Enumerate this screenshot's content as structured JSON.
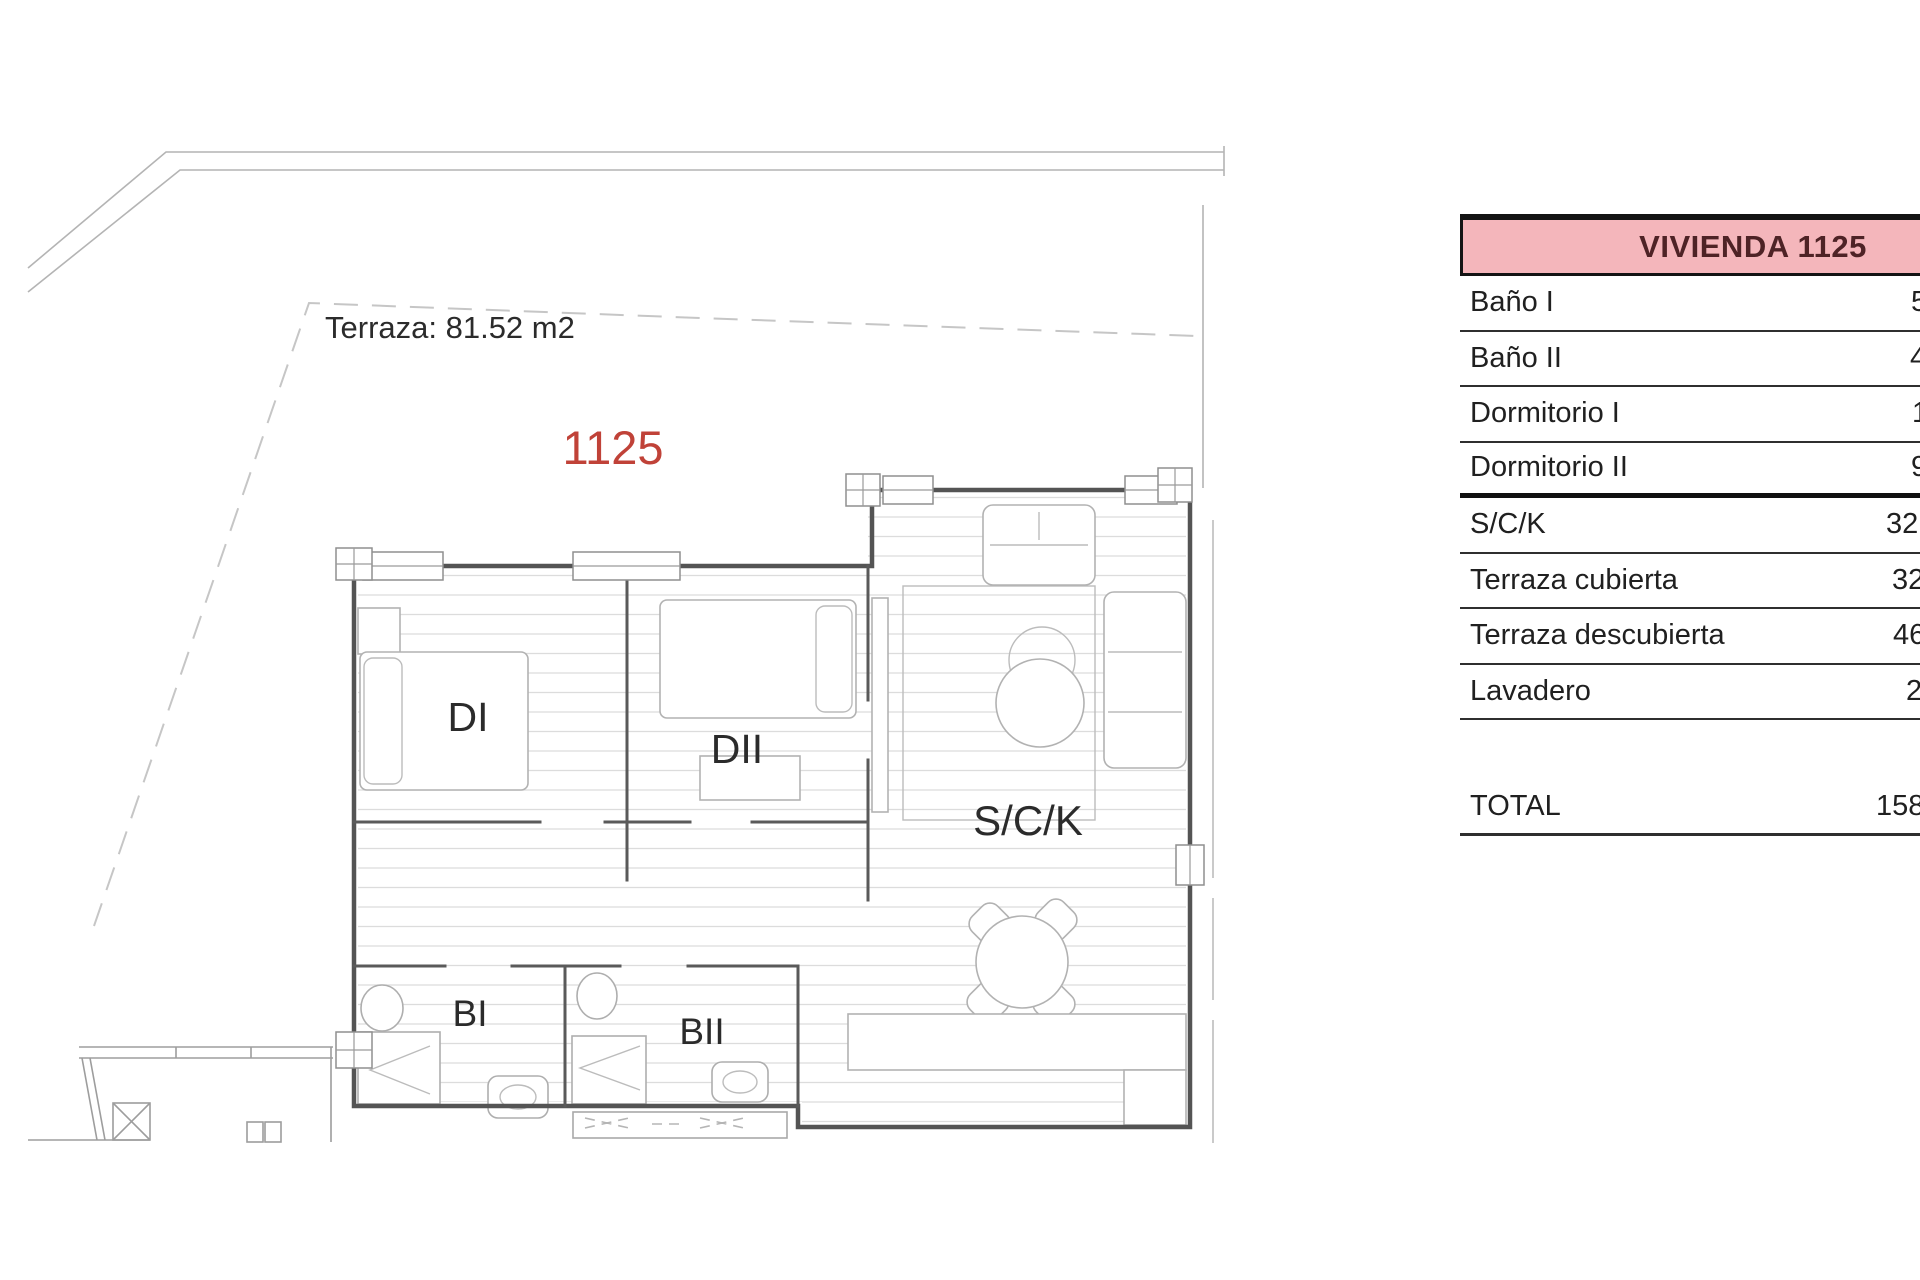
{
  "page_title": "Plano de planta Vivienda 1125",
  "floor_plan": {
    "terrace_label": "Terraza: 81.52 m2",
    "unit_number": "1125",
    "rooms": {
      "di": "DI",
      "dii": "DII",
      "sck": "S/C/K",
      "bi": "BI",
      "bii": "BII"
    },
    "colors": {
      "unit_number_red": "#c04238",
      "wall_gray": "#545454"
    }
  },
  "table": {
    "header": "VIVIENDA 1125",
    "colors": {
      "header_bg": "#f4b6bb",
      "header_text": "#4e2326"
    },
    "rows": [
      {
        "label": "Baño I",
        "value": "5"
      },
      {
        "label": "Baño II",
        "value": "4"
      },
      {
        "label": "Dormitorio I",
        "value": "1"
      },
      {
        "label": "Dormitorio II",
        "value": "9"
      },
      {
        "label": "S/C/K",
        "value": "32"
      },
      {
        "label": "Terraza cubierta",
        "value": "32"
      },
      {
        "label": "Terraza descubierta",
        "value": "46"
      },
      {
        "label": "Lavadero",
        "value": "2"
      }
    ],
    "total": {
      "label": "TOTAL",
      "value": "158"
    }
  }
}
